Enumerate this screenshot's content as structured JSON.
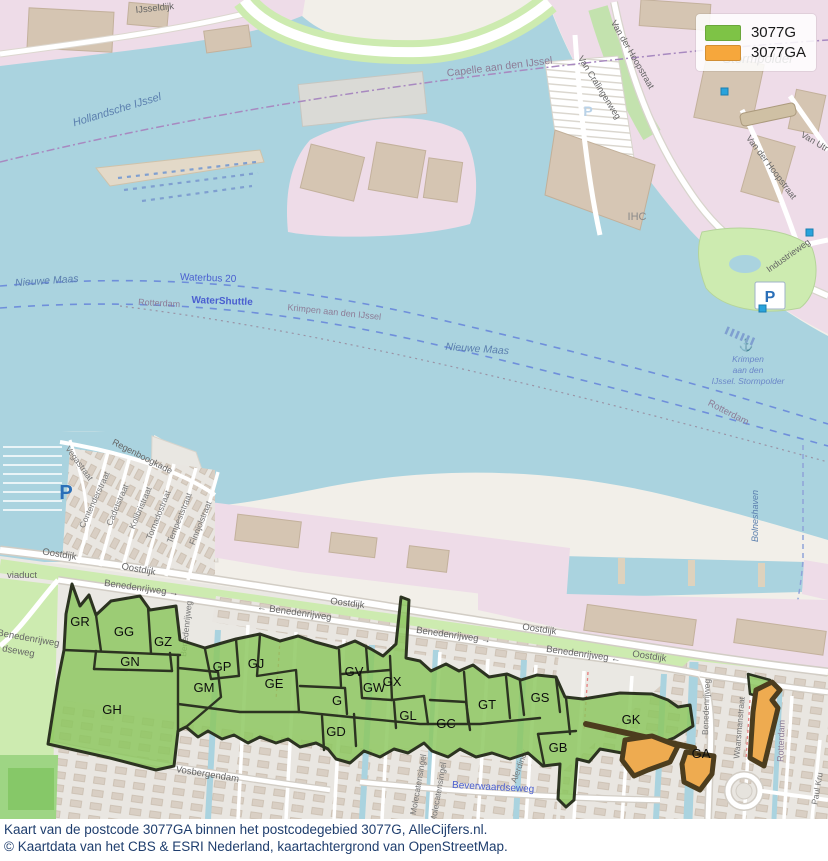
{
  "colors": {
    "legend_green": "#7ec346",
    "legend_orange": "#f6a73c",
    "region_green_fill": "#8cc75e",
    "region_green_outline": "#2c3321",
    "region_orange_fill": "#eeab50",
    "region_orange_outline": "#4c3d1e",
    "water": "#aad3df",
    "caption_text": "#1f3e6e"
  },
  "legend": {
    "items": [
      {
        "label": "3077G",
        "color": "#7ec346"
      },
      {
        "label": "3077GA",
        "color": "#f6a73c"
      }
    ]
  },
  "caption": {
    "line1": "Kaart van de postcode 3077GA binnen het postcodegebied 3077G, AlleCijfers.nl.",
    "line2": "© Kaartdata van het CBS & ESRI Nederland, kaartachtergrond van OpenStreetMap."
  },
  "map": {
    "icons": {
      "parking": "P",
      "anchor": "⚓"
    },
    "region_labels": [
      {
        "text": "GR"
      },
      {
        "text": "GG"
      },
      {
        "text": "GZ"
      },
      {
        "text": "GN"
      },
      {
        "text": "GH"
      },
      {
        "text": "GM"
      },
      {
        "text": "GP"
      },
      {
        "text": "GJ"
      },
      {
        "text": "GE"
      },
      {
        "text": "G"
      },
      {
        "text": "GV"
      },
      {
        "text": "GW"
      },
      {
        "text": "GX"
      },
      {
        "text": "GL"
      },
      {
        "text": "GD"
      },
      {
        "text": "GC"
      },
      {
        "text": "GT"
      },
      {
        "text": "GS"
      },
      {
        "text": "GK"
      },
      {
        "text": "GB"
      },
      {
        "text": "GA"
      }
    ],
    "labels": [
      {
        "text": "IJsseldijk"
      },
      {
        "text": "Capelle aan den IJssel"
      },
      {
        "text": "Hollandsche IJssel"
      },
      {
        "text": "Nieuwe Maas"
      },
      {
        "text": "Waterbus 20"
      },
      {
        "text": "Rotterdam"
      },
      {
        "text": "WaterShuttle"
      },
      {
        "text": "Krimpen aan den IJssel"
      },
      {
        "text": "Nieuwe Maas"
      },
      {
        "text": "Rotterdam"
      },
      {
        "text": "Krimpen"
      },
      {
        "text": "aan den"
      },
      {
        "text": "IJssel. Stormpolder"
      },
      {
        "text": "Bolneshaven"
      },
      {
        "text": "Stormpolder"
      },
      {
        "text": "IHC"
      },
      {
        "text": "Industrieweg"
      },
      {
        "text": "Van der Hoopstraat"
      },
      {
        "text": "Van Cralingenweg"
      },
      {
        "text": "Van der Hoopstraat"
      },
      {
        "text": "Van Utr"
      },
      {
        "text": "Regenboogkade"
      },
      {
        "text": "Vegastraat"
      },
      {
        "text": "Contenderstraat"
      },
      {
        "text": "Cadetstraat"
      },
      {
        "text": "Kolibristraat"
      },
      {
        "text": "Tornadostraat"
      },
      {
        "text": "Tempeststraat"
      },
      {
        "text": "Finnjolstraat"
      },
      {
        "text": "Oostdijk"
      },
      {
        "text": "Oostdijk"
      },
      {
        "text": "Oostdijk"
      },
      {
        "text": "Oostdijk"
      },
      {
        "text": "Oostdijk"
      },
      {
        "text": "viaduct"
      },
      {
        "text": "Benedenrijweg →"
      },
      {
        "text": "← Benedenrijweg"
      },
      {
        "text": "Benedenrijweg →"
      },
      {
        "text": "Benedenrijweg ←"
      },
      {
        "text": "Benedenrijweg"
      },
      {
        "text": "Benedenrijweg"
      },
      {
        "text": "Benedenrijweg"
      },
      {
        "text": "dseweg"
      },
      {
        "text": "Vosbergendam"
      },
      {
        "text": "Beverwaardseweg"
      },
      {
        "text": "Molecatensingel"
      },
      {
        "text": "Molecatensingel"
      },
      {
        "text": "Alerdinck"
      },
      {
        "text": "Waarsmanstraat"
      },
      {
        "text": "Rotterdam"
      },
      {
        "text": "Paul Kru"
      }
    ]
  }
}
